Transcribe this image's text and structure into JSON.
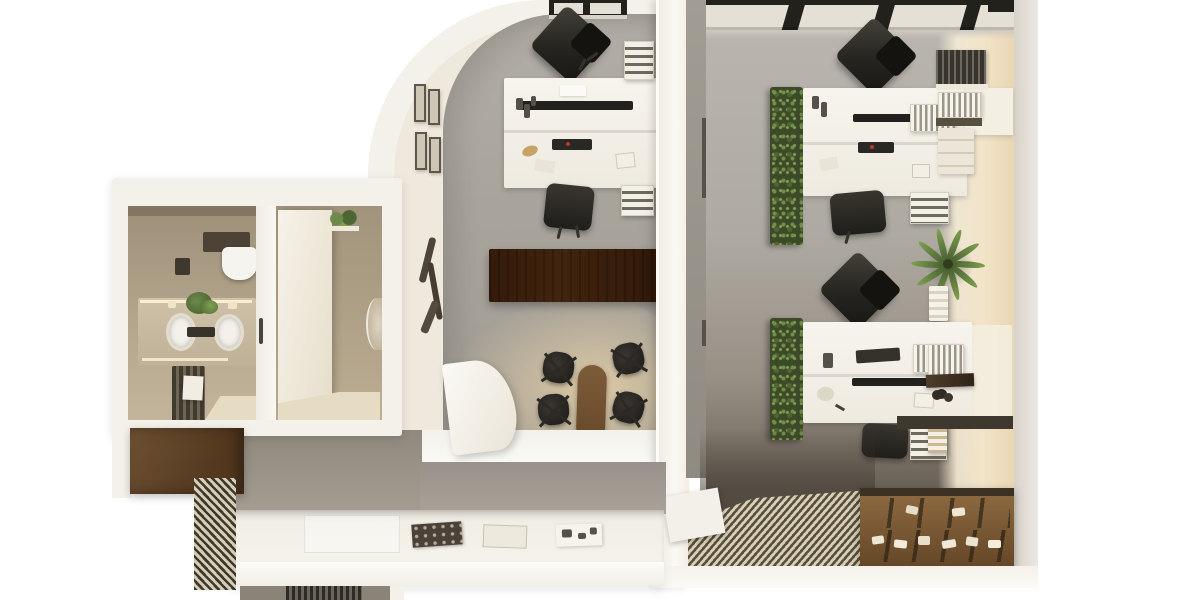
{
  "meta": {
    "title": "Top-down 3D render of an office floor plan",
    "view": "top-down axonometric",
    "visible_text": "none"
  },
  "palette": {
    "bg": "#ffffff",
    "wall_white": "#f4f1ea",
    "wall_bright": "#fbfaf6",
    "wall_cream": "#efe9dd",
    "sunlit": "#f2e4c8",
    "sunlit_deep": "#e9d6b4",
    "floor_mid": "#a8a49c",
    "floor_right": "#aeaaa2",
    "floor_dark": "#5a5248",
    "floor_warm": "#decba5",
    "tan": "#b4a68d",
    "tan_dark": "#9e9078",
    "cream_floor": "#e6dcc4",
    "wood": "#7a5a38",
    "wood_dark": "#553d26",
    "wood_deep": "#3c3122",
    "black_furniture": "#26241f",
    "green": "#5d7a40",
    "green_light": "#7fa050",
    "white_furniture": "#f6f3ec",
    "win_frame": "#23211c",
    "win_pane": "#e4e0d6",
    "slat_light": "#d9cfb6",
    "slat_dark": "#57503f"
  },
  "scene": {
    "rooms": [
      {
        "name": "restroom-left",
        "furniture": [
          "wall-hung-toilet",
          "double-sink-vanity",
          "lit-mirror",
          "radiator-with-towel",
          "counter-plant",
          "cream-floor-wedge"
        ]
      },
      {
        "name": "restroom-right",
        "furniture": [
          "open-door-leaf",
          "round-wall-mirror",
          "hanging-plant-shelf",
          "cream-floor"
        ]
      },
      {
        "name": "arched-office-middle",
        "furniture": [
          "arched-corner-wall",
          "window-top",
          "gallery-picture-frames",
          "dark-wall-art",
          "double-desk-island",
          "monitor-bar",
          "task-chair-top",
          "task-chair-bottom",
          "binder-shelf-top",
          "binder-shelf-bottom",
          "wood-credenza",
          "oval-meeting-table",
          "four-black-meeting-chairs",
          "curved-white-partition"
        ]
      },
      {
        "name": "open-office-right",
        "furniture": [
          "skylight-window-band",
          "green-plant-wall-top",
          "double-desk-top",
          "green-plant-wall-bottom",
          "double-desk-bottom",
          "diagonal-task-chairs",
          "binder-shelves",
          "palm-plant",
          "sunlit-wall",
          "wall-book-shelves",
          "dark-wall-ledge"
        ]
      },
      {
        "name": "reception-corridor-bottom",
        "furniture": [
          "white-reception-counter",
          "three-magazines",
          "recessed-tray",
          "dark-wood-cabinet",
          "diagonal-slat-screen",
          "diagonal-slat-floor",
          "wood-storage-shelf-with-items",
          "white-rug",
          "dark-slatted-room-sliver"
        ]
      }
    ]
  }
}
